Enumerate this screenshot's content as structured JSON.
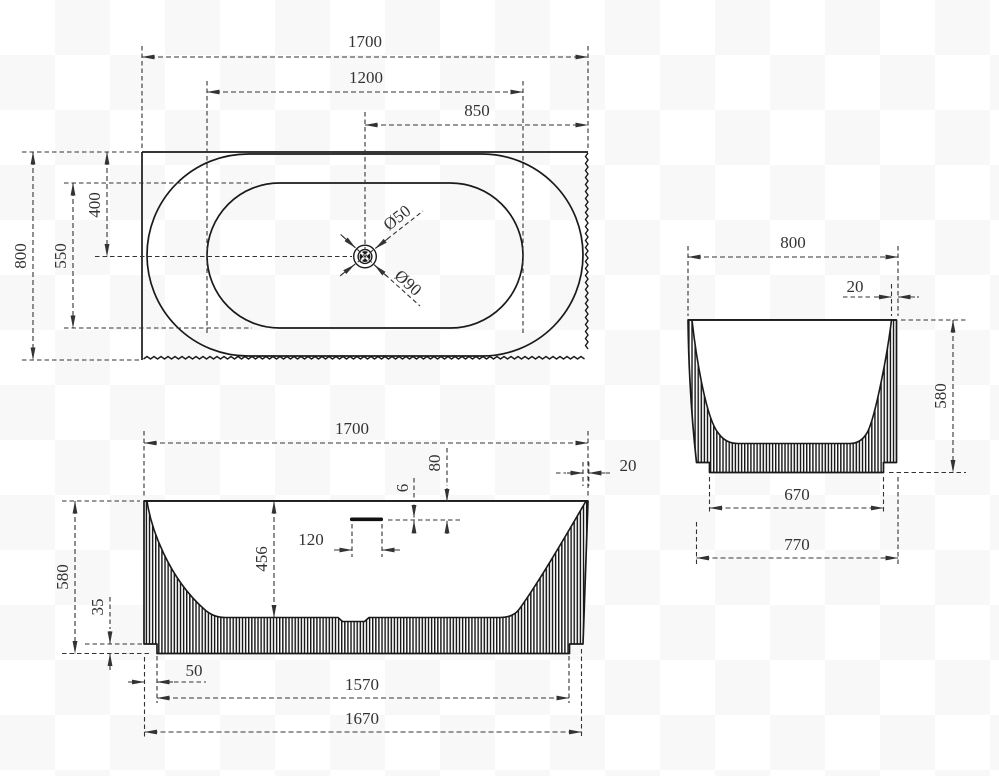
{
  "plan": {
    "length": "1700",
    "inner_length": "1200",
    "drain_from_end": "850",
    "width": "800",
    "inner_width": "550",
    "drain_from_back": "400",
    "drain_small_dia": "Ø50",
    "drain_large_dia": "Ø90"
  },
  "front": {
    "length": "1700",
    "height": "580",
    "plinth_height": "35",
    "inner_depth": "456",
    "overflow_width": "120",
    "overflow_slot_height": "6",
    "overflow_from_rim": "80",
    "wall_taper": "20",
    "base_inset": "50",
    "base_length": "1570",
    "bottom_length": "1670"
  },
  "side": {
    "width": "800",
    "wall_thickness": "20",
    "height": "580",
    "base_width": "670",
    "bottom_width": "770"
  },
  "colors": {
    "line": "#1a1a1a",
    "dim": "#333333"
  }
}
